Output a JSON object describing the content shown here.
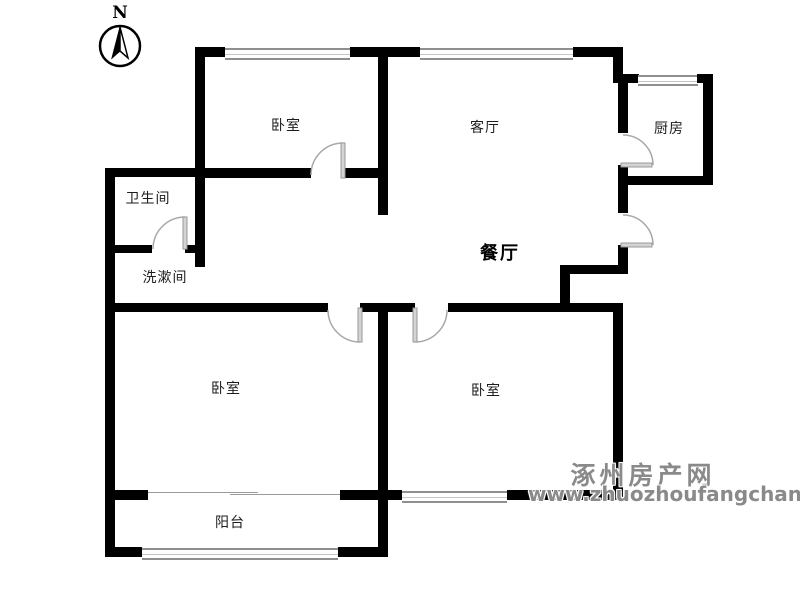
{
  "floorplan": {
    "compass": {
      "label": "N"
    },
    "rooms": {
      "bedroom_top": {
        "label": "卧室"
      },
      "living_room": {
        "label": "客厅"
      },
      "kitchen": {
        "label": "厨房"
      },
      "bathroom": {
        "label": "卫生间"
      },
      "washroom": {
        "label": "洗漱间"
      },
      "dining_room": {
        "label": "餐厅"
      },
      "bedroom_left": {
        "label": "卧室"
      },
      "bedroom_right": {
        "label": "卧室"
      },
      "balcony": {
        "label": "阳台"
      }
    }
  },
  "watermark": {
    "site_name": "涿州房产网",
    "site_url": "www.zhuozhoufangchan.com"
  },
  "colors": {
    "wall": "#000000",
    "door_arc": "#a8a8a8",
    "door_leaf": "#d4d4d4",
    "window_line": "#8f8f8f",
    "watermark_text": "#8a8a8a",
    "background": "#ffffff"
  }
}
